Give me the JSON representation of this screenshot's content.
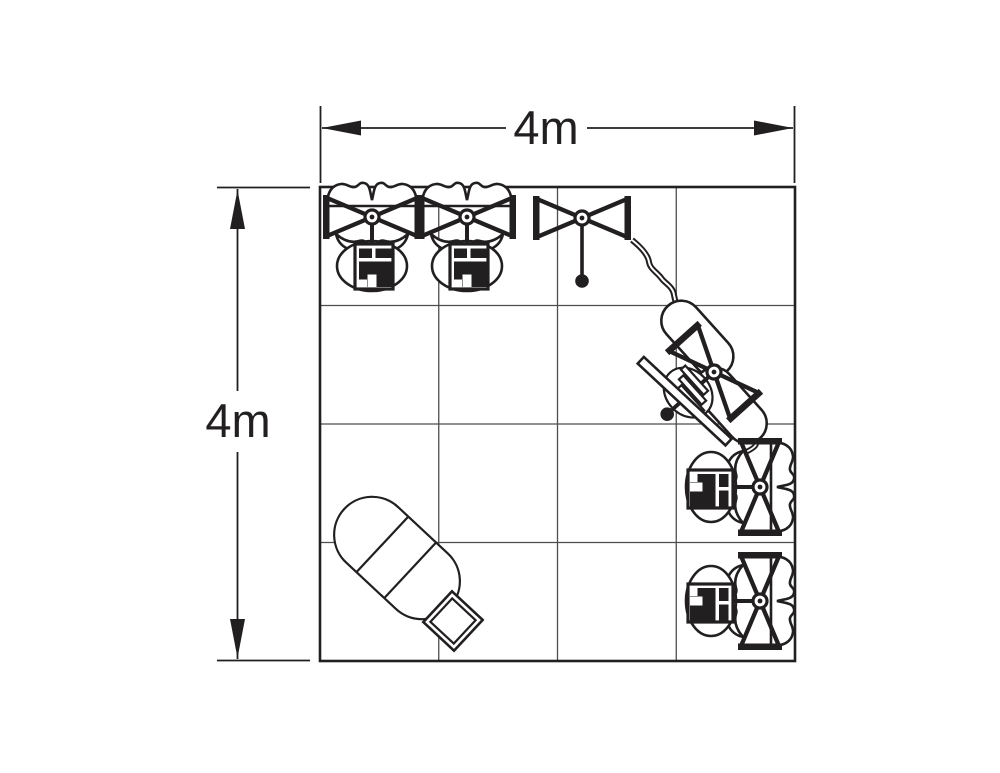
{
  "diagram": {
    "width_label": "4m",
    "depth_label": "4m",
    "grid_columns": 4,
    "grid_rows": 4,
    "colors": {
      "line": "#221f20",
      "grid_line": "#4e4e4e",
      "shade": "#b0b0b0",
      "background": "#ffffff"
    },
    "elements": {
      "top_wall": [
        "fabric-display-workstation",
        "fabric-display-workstation",
        "open-truss-display"
      ],
      "diagonal_wall": "fabric-pod-workstation-with-counter",
      "right_wall": [
        "fabric-display-workstation",
        "fabric-display-workstation"
      ],
      "floor": [
        "oval-meeting-table",
        "guest-chair"
      ]
    }
  }
}
